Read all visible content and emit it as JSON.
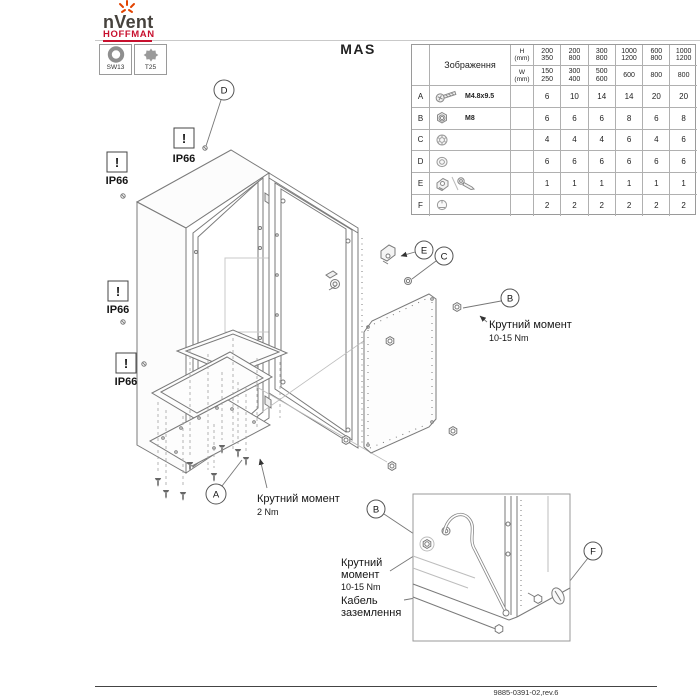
{
  "header": {
    "brand": "nVent",
    "brand_sub": "HOFFMAN",
    "title": "MAS",
    "tools": [
      {
        "label": "SW13",
        "icon": "hex-socket-icon"
      },
      {
        "label": "T25",
        "icon": "torx-icon"
      }
    ]
  },
  "parts_table": {
    "image_header": "Зображення",
    "h_label": "H\n(mm)",
    "w_label": "W\n(mm)",
    "h_values": [
      "200\n350",
      "200\n800",
      "300\n800",
      "1000\n1200",
      "600\n800",
      "1000\n1200"
    ],
    "w_values": [
      "150\n250",
      "300\n400",
      "500\n600",
      "600",
      "800",
      "800"
    ],
    "rows": [
      {
        "letter": "A",
        "icon": "screw-icon",
        "label": "M4.8x9.5",
        "values": [
          "6",
          "10",
          "14",
          "14",
          "20",
          "20"
        ]
      },
      {
        "letter": "B",
        "icon": "nut-icon",
        "label": "M8",
        "values": [
          "6",
          "6",
          "6",
          "8",
          "6",
          "8"
        ]
      },
      {
        "letter": "C",
        "icon": "serrated-washer-icon",
        "label": "",
        "values": [
          "4",
          "4",
          "4",
          "6",
          "4",
          "6"
        ]
      },
      {
        "letter": "D",
        "icon": "washer-icon",
        "label": "",
        "values": [
          "6",
          "6",
          "6",
          "6",
          "6",
          "6"
        ]
      },
      {
        "letter": "E",
        "icon": "bracket-key-icon",
        "label": "",
        "values": [
          "1",
          "1",
          "1",
          "1",
          "1",
          "1"
        ]
      },
      {
        "letter": "F",
        "icon": "plug-icon",
        "label": "",
        "values": [
          "2",
          "2",
          "2",
          "2",
          "2",
          "2"
        ]
      }
    ]
  },
  "diagram": {
    "ip66_warning": "!",
    "ip66_label": "IP66",
    "callouts": {
      "a": "A",
      "b": "B",
      "c": "C",
      "d": "D",
      "e": "E",
      "f": "F"
    },
    "annotations": {
      "torque_body_1": "Крутний момент",
      "torque_body_2": "10-15 Nm",
      "torque_plate_1": "Крутний момент",
      "torque_plate_2": "2 Nm",
      "inset_torque_1": "Крутний",
      "inset_torque_2": "момент",
      "inset_torque_3": "10-15 Nm",
      "ground_1": "Кабель",
      "ground_2": "заземлення"
    }
  },
  "footer": {
    "doc_number": "9885-0391-02,rev.6"
  },
  "colors": {
    "brand_red": "#c8102e",
    "spark_orange": "#e24301",
    "line_gray": "#7a7a7a"
  }
}
